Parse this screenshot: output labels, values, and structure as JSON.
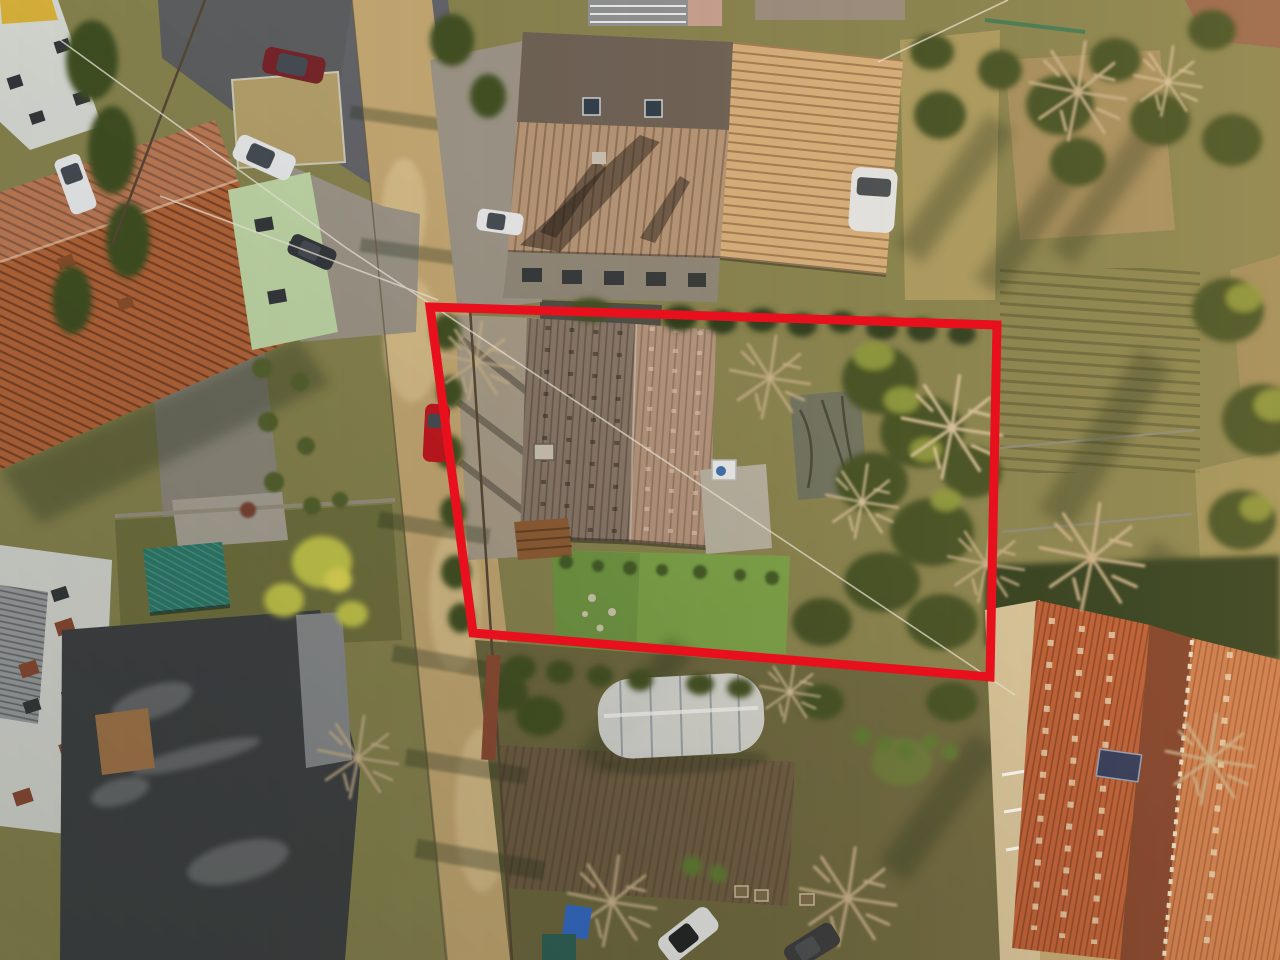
{
  "photo": {
    "kind": "aerial-drone-photograph",
    "orientation": "top-down",
    "objects": [
      "red property boundary outline",
      "subject house with weathered tile roof",
      "subject garden with lawn, terrace, shed and bare trees",
      "dirt road running diagonally",
      "terracotta roof house top-left",
      "large gray-brown roof house top-center",
      "white apartment building bottom-left",
      "dark weathered barn roof bottom-left",
      "orange tile roof building bottom-right with solar panel",
      "allotment gardens right side",
      "greenhouse tunnel bottom-center",
      "parked cars",
      "blue tarp",
      "power lines"
    ]
  },
  "boundary": {
    "points": "430,307 997,325 990,677 473,633",
    "color": "#e8101c",
    "stroke_width": "9"
  },
  "overlays": {
    "warm_light": "#ffc878",
    "cool_shade": "#141a0e"
  },
  "colors": {
    "ground_base": "#87834f",
    "ground_sun": "#b3a164",
    "plot_dry": "#a58f5e",
    "grass_left": "#70713f",
    "paving_gray": "#8d887c",
    "gravel_light": "#9c9588",
    "gravel_drive": "#a79c88",
    "asphalt": "#5c5e60",
    "asphalt_court": "#62646a",
    "road_dirt": "#c4a873",
    "road_sand": "#d9c08c",
    "dry_grass": "#b3a06b",
    "lawn": "#7aa348",
    "soil_tilled": "#6d5c43",
    "garden_bottom": "#6b673f",
    "hedge_dark": "#2c3a1e",
    "tree_green": "#3f4f24",
    "tree_sunlit": "#8e9a3c",
    "bush_yellow": "#c4c84b",
    "bare_branch": "#c9b28d",
    "bare_branch_light": "#d8c49e",
    "shadow": "#1f2a14",
    "stone": "#a8a296",
    "stone_light": "#cfc9b0",
    "roof_terracotta": "#b2653a",
    "roof_terracotta_light": "#c27845",
    "roof_center_sun": "#d8b07c",
    "roof_center_shade": "#b79678",
    "roof_center_dark": "#6d6156",
    "wall_gray": "#8f8779",
    "subject_roof_left": "#887769",
    "subject_roof_right": "#b4957f",
    "shed_flat": "#6d7260",
    "terrace_pale": "#b7b2a3",
    "deck_wood": "#8d5c34",
    "teal_shed": "#2c7b6c",
    "corrugated_gray": "#9b9ea0",
    "barn_dark": "#3e4143",
    "barn_light": "#888b8d",
    "shed_brown": "#a3764a",
    "orange_roof": "#bc5a33",
    "orange_roof_light": "#cd7a4b",
    "orange_roof_dark": "#7d3c28",
    "cream_wall": "#d8c69e",
    "white_building": "#d6d8d2",
    "window_dark": "#34383b",
    "shutter_brown": "#8a4a33",
    "brick": "#96654b",
    "solar_panel": "#27335a",
    "greenhouse": "#e9ecef",
    "greenhouse_rib": "#9aa4ad",
    "green_facade": "#bfd6a6",
    "car_white": "#e7e9ea",
    "car_dark": "#33373c",
    "car_red": "#c3161f",
    "car_darkred": "#77252a",
    "glass_dark": "#454c53",
    "tarp_blue": "#2f68c9",
    "teal_bin": "#2a5f55",
    "wire": "#efe9dc",
    "fence_dark": "#574836",
    "fence_green": "#3f7a55",
    "balcony_gray": "#8f9294",
    "pink_wall": "#c9a193",
    "buoy_red": "#c24a33",
    "chimney_pale": "#cbc3b4"
  }
}
